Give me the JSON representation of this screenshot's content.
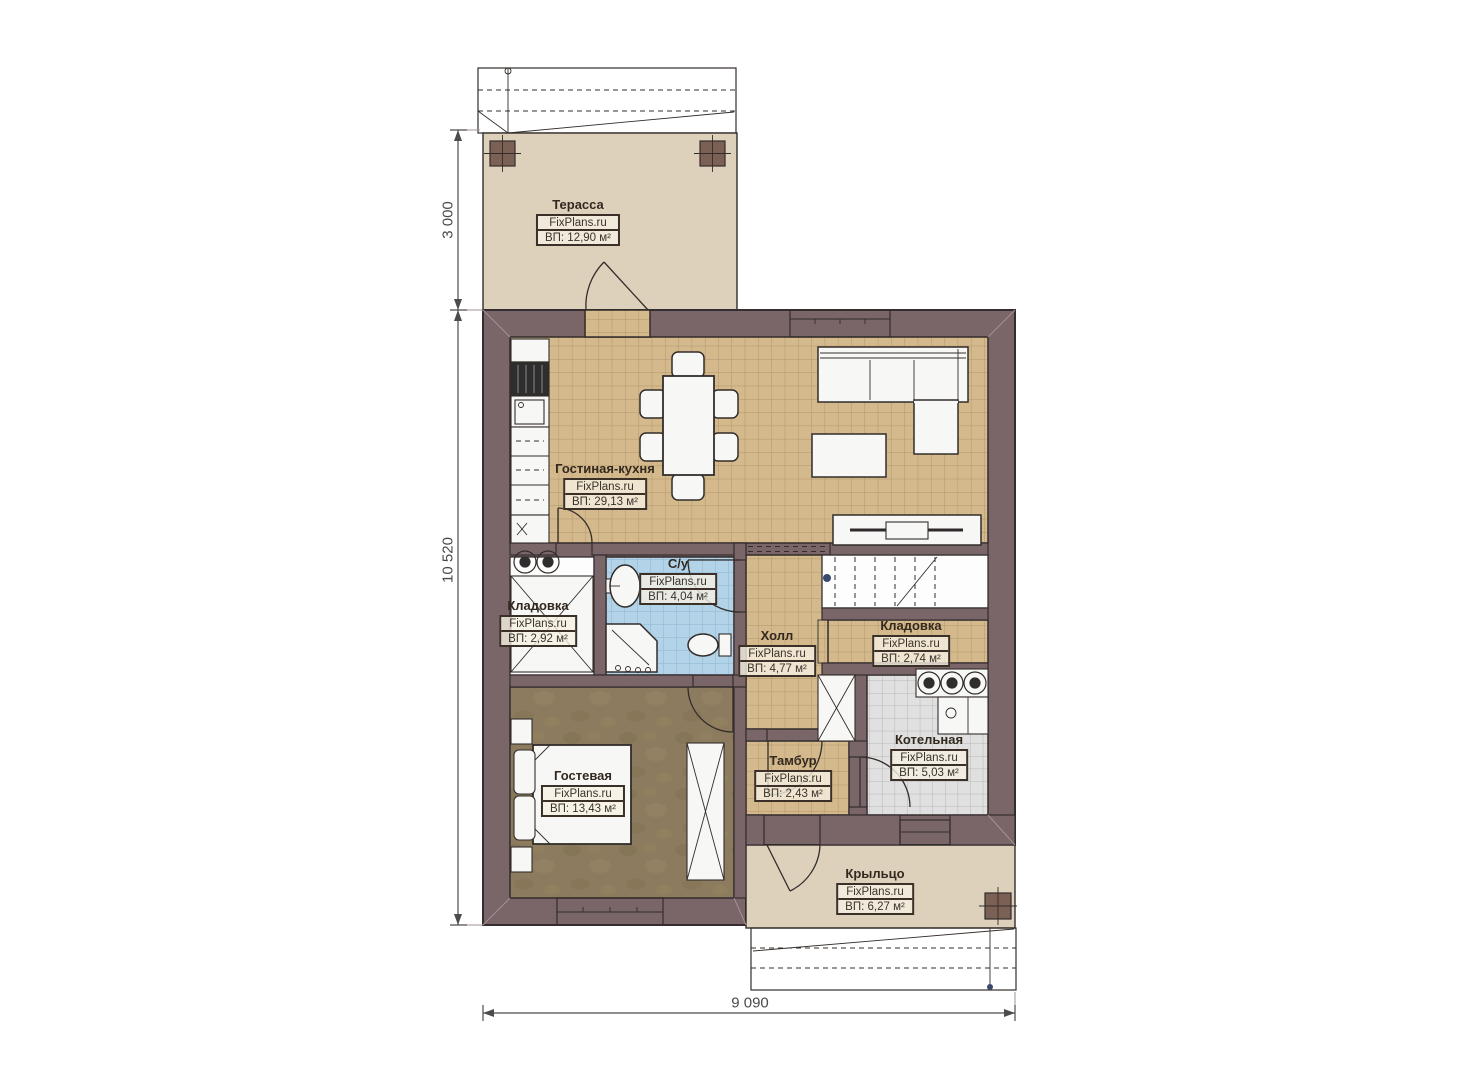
{
  "plan": {
    "brand": "FixPlans.ru",
    "rooms": [
      {
        "id": "terrace",
        "name": "Терасса",
        "area": "ВП: 12,90 м²"
      },
      {
        "id": "living-kitchen",
        "name": "Гостиная-кухня",
        "area": "ВП: 29,13 м²"
      },
      {
        "id": "bathroom",
        "name": "С/у",
        "area": "ВП: 4,04 м²"
      },
      {
        "id": "storage-left",
        "name": "Кладовка",
        "area": "ВП: 2,92 м²"
      },
      {
        "id": "hall",
        "name": "Холл",
        "area": "ВП: 4,77 м²"
      },
      {
        "id": "storage-right",
        "name": "Кладовка",
        "area": "ВП: 2,74 м²"
      },
      {
        "id": "boiler-room",
        "name": "Котельная",
        "area": "ВП: 5,03 м²"
      },
      {
        "id": "guest-room",
        "name": "Гостевая",
        "area": "ВП: 13,43 м²"
      },
      {
        "id": "vestibule",
        "name": "Тамбур",
        "area": "ВП: 2,43 м²"
      },
      {
        "id": "porch",
        "name": "Крыльцо",
        "area": "ВП: 6,27 м²"
      }
    ],
    "dimensions": {
      "left_top": "3 000",
      "left_main": "10 520",
      "bottom": "9 090"
    },
    "colors": {
      "wall": "#7a6569",
      "wall_line": "#352d30",
      "ink": "#332d2a",
      "tile": "#d3b98c",
      "tile_line": "#b2976a",
      "bath": "#b2d3e8",
      "bath_line": "#8db4d1",
      "boiler": "#e0e0e0",
      "boiler_line": "#b7b7b7",
      "guest": "#8c7b5e",
      "terrace": "#ddd1bc",
      "furniture": "#f7f7f6",
      "post": "#7b6055",
      "dim": "#4c4c4c"
    }
  }
}
